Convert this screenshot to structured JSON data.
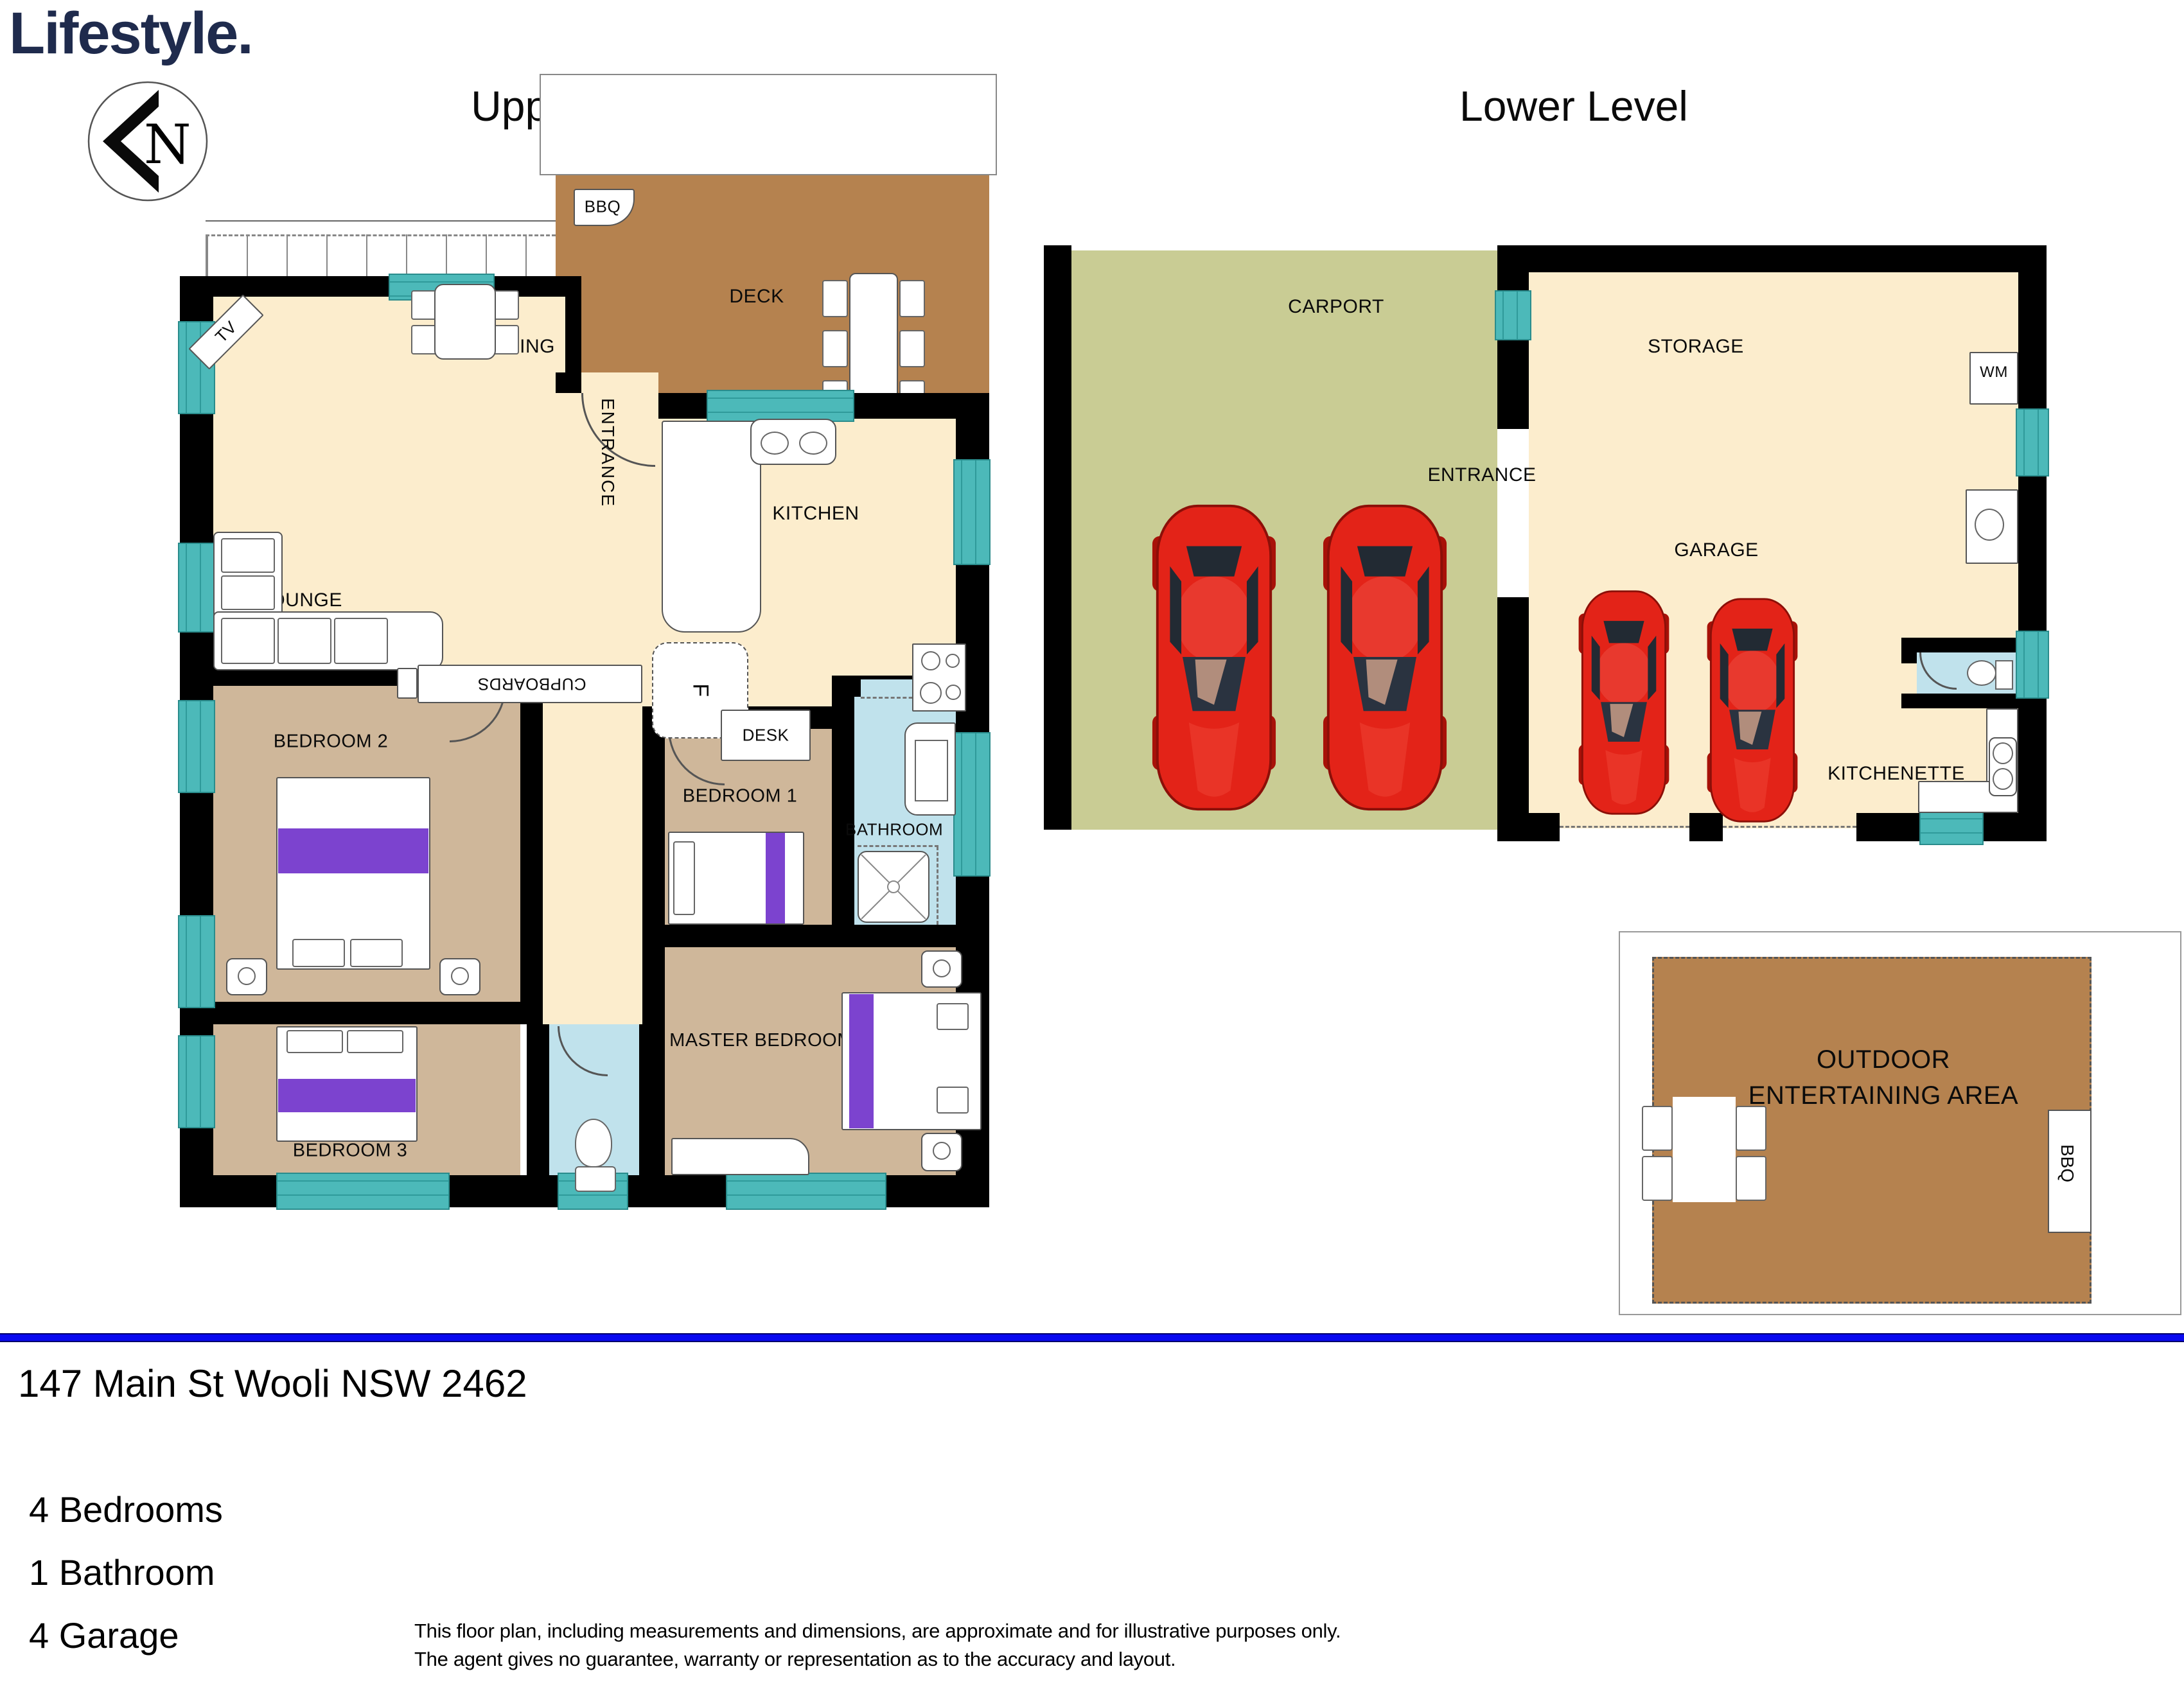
{
  "brand": {
    "logo_text": "Lifestyle.",
    "compass_letter": "N"
  },
  "titles": {
    "upper": "Upper level",
    "lower": "Lower Level"
  },
  "upper_level": {
    "deck": "DECK",
    "bbq": "BBQ",
    "entrance": "ENTRANCE",
    "kitchen": "KITCHEN",
    "dining": "DINING",
    "lounge": "LOUNGE",
    "tv": "TV",
    "cupboards": "CUPBOARDS",
    "fridge": "F",
    "desk": "DESK",
    "bedroom1": "BEDROOM 1",
    "bedroom2": "BEDROOM 2",
    "bedroom3": "BEDROOM 3",
    "bathroom": "BATHROOM",
    "master_bedroom": "MASTER BEDROOM"
  },
  "lower_level": {
    "carport": "CARPORT",
    "storage": "STORAGE",
    "washing_machine": "WM",
    "entrance": "ENTRANCE",
    "garage": "GARAGE",
    "kitchenette": "KITCHENETTE"
  },
  "outdoor_area": {
    "label": "OUTDOOR ENTERTAINING AREA",
    "bbq": "BBQ"
  },
  "footer": {
    "address": "147 Main St Wooli NSW 2462",
    "features": [
      "4 Bedrooms",
      "1 Bathroom",
      "4 Garage"
    ],
    "disclaimer_line1": "This floor plan, including measurements and dimensions, are approximate and for illustrative purposes only.",
    "disclaimer_line2": "The agent gives no guarantee, warranty or representation as to the accuracy and layout."
  },
  "colors": {
    "wall_black": "#000000",
    "floor_cream": "#fcedcd",
    "floor_tan": "#cfb79a",
    "deck_brown": "#b5824f",
    "carport_green": "#c9cc94",
    "wet_area_blue": "#c0e2ec",
    "window_teal": "#4cb9b9",
    "bed_runner_purple": "#7c43cf",
    "divider_blue": "#0a0af0",
    "logo_navy": "#1f2b4d",
    "car_red": "#e32318"
  }
}
